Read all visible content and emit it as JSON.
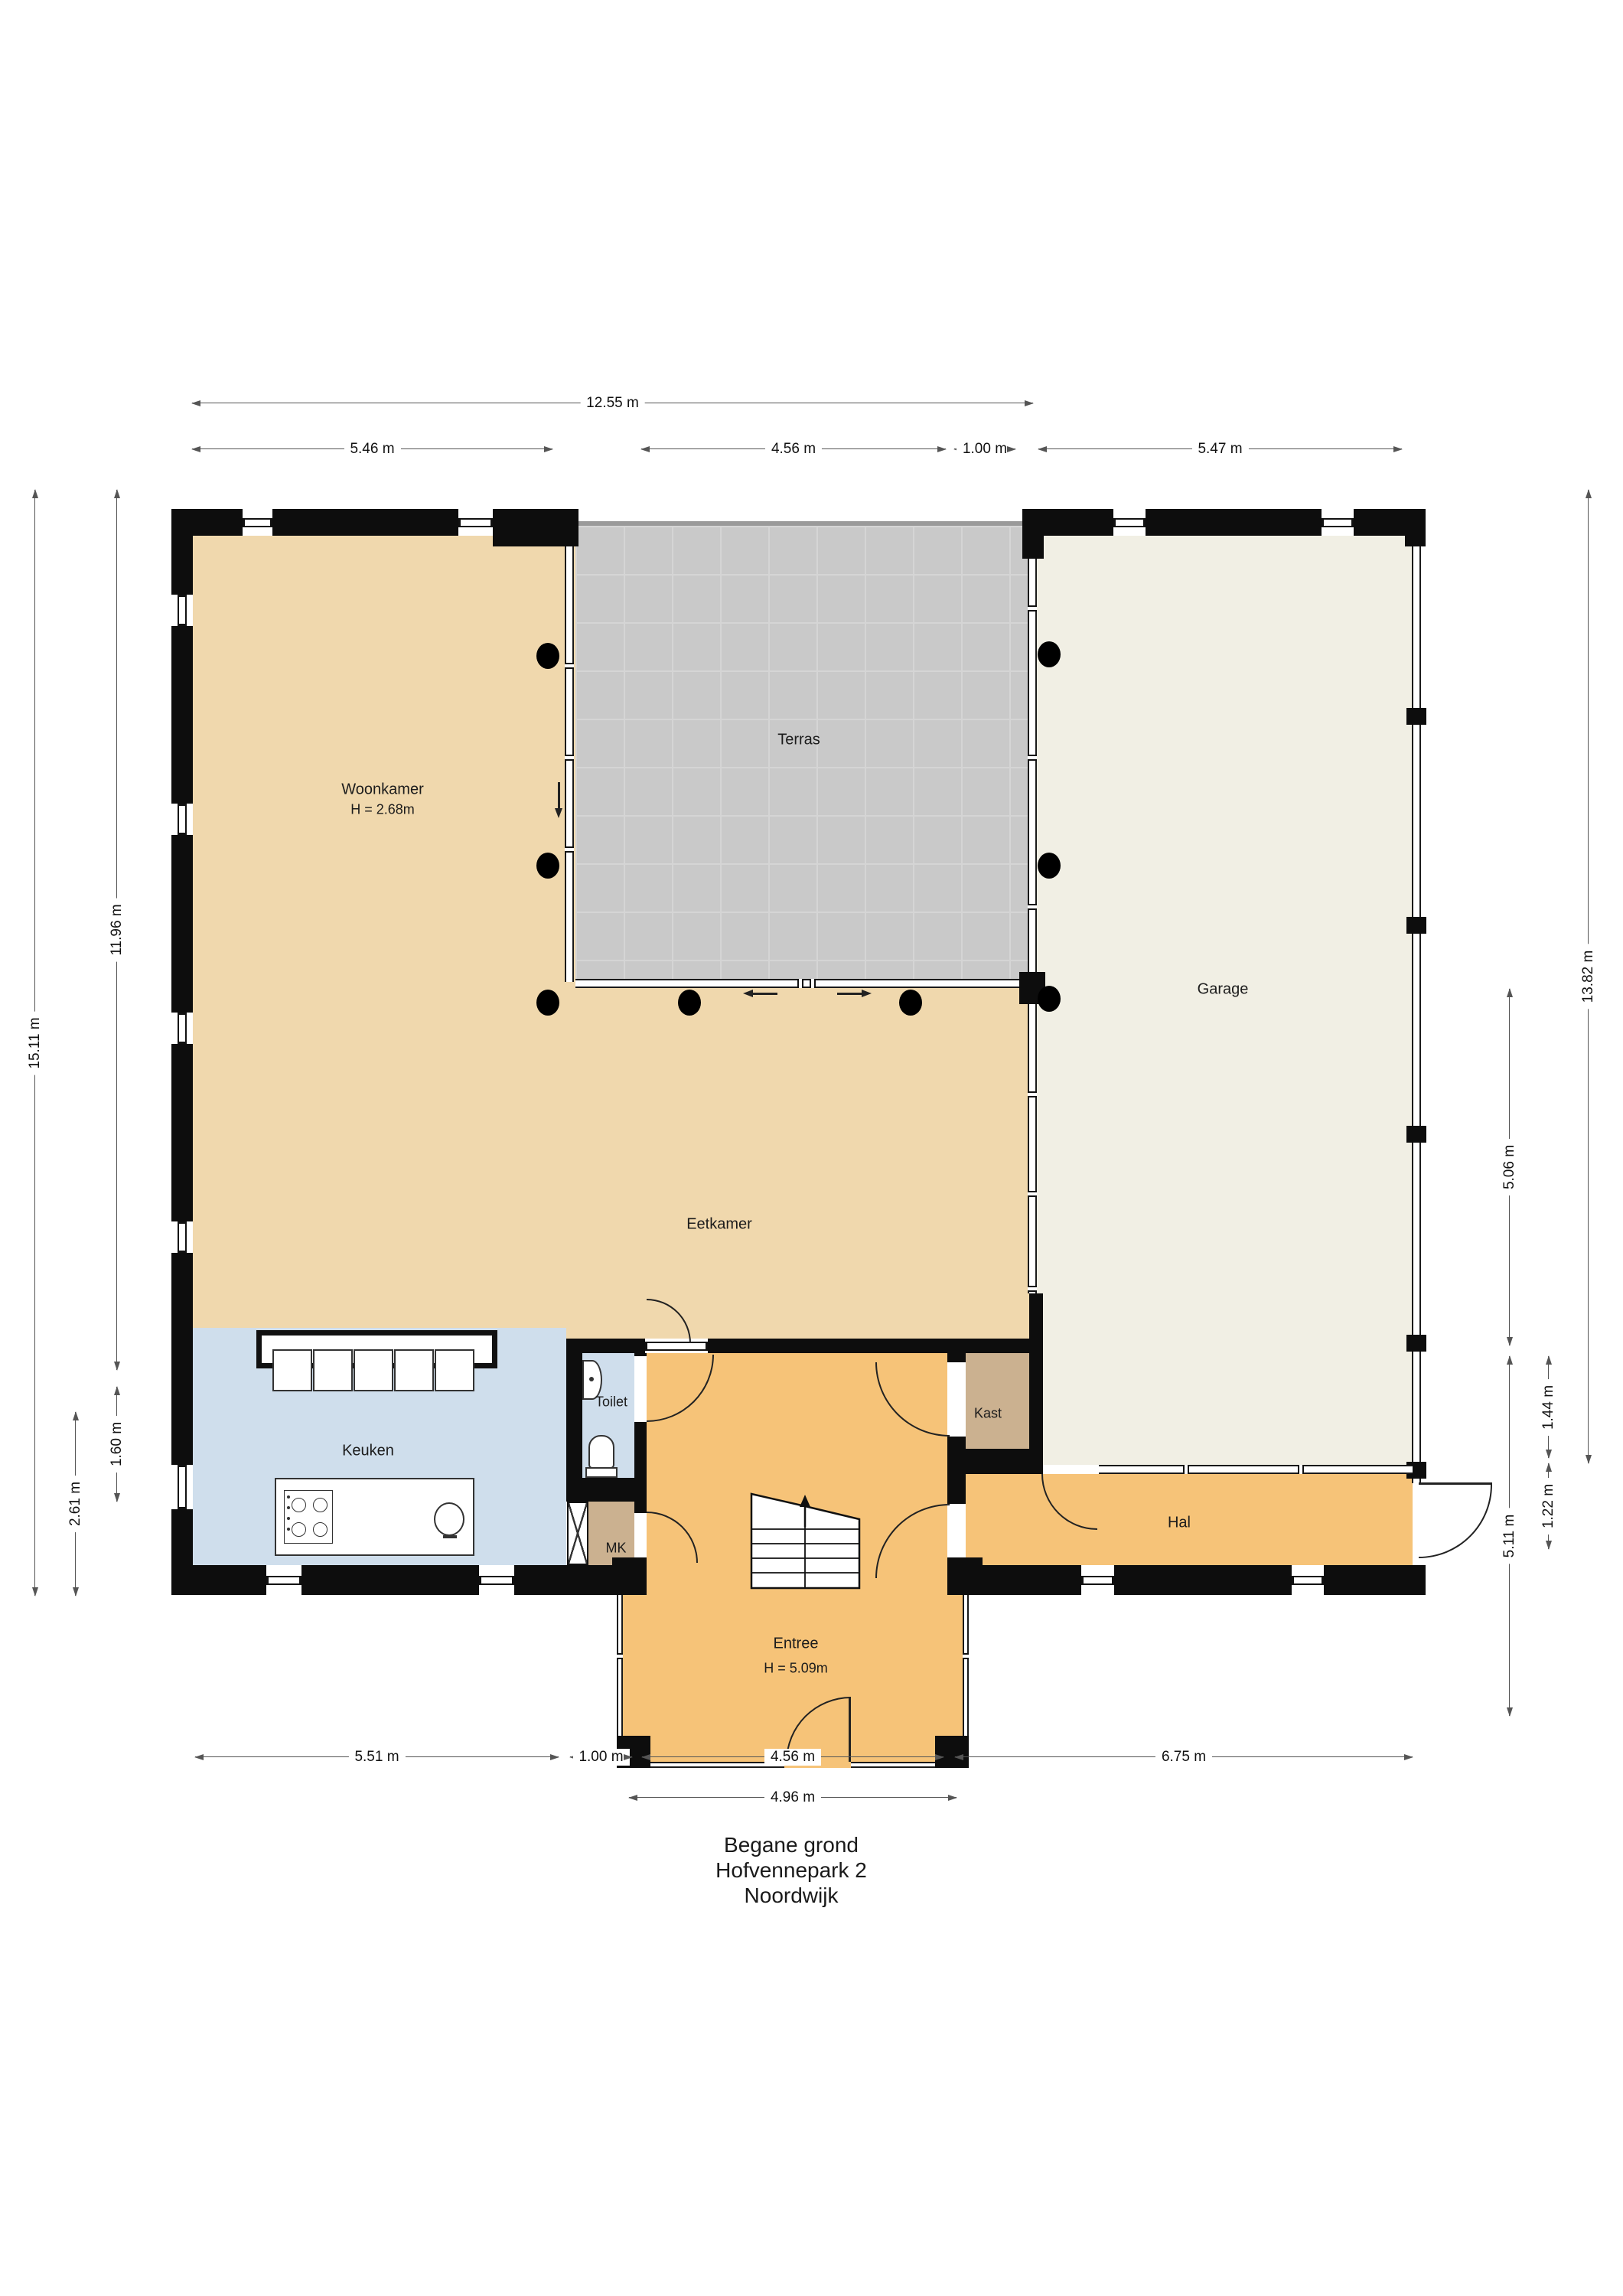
{
  "title": {
    "line1": "Begane grond",
    "line2": "Hofvennepark 2",
    "line3": "Noordwijk"
  },
  "rooms": {
    "woonkamer": {
      "label": "Woonkamer",
      "height": "H = 2.68m"
    },
    "terras": {
      "label": "Terras"
    },
    "garage": {
      "label": "Garage"
    },
    "eetkamer": {
      "label": "Eetkamer"
    },
    "keuken": {
      "label": "Keuken"
    },
    "toilet": {
      "label": "Toilet"
    },
    "mk": {
      "label": "MK"
    },
    "kast": {
      "label": "Kast"
    },
    "hal": {
      "label": "Hal"
    },
    "entree": {
      "label": "Entree",
      "height": "H = 5.09m"
    }
  },
  "dimensions": {
    "top": [
      {
        "label": "12.55 m"
      },
      {
        "label": "5.46 m"
      },
      {
        "label": "4.56 m"
      },
      {
        "label": "1.00 m"
      },
      {
        "label": "5.47 m"
      }
    ],
    "bottom": [
      {
        "label": "5.51 m"
      },
      {
        "label": "1.00 m"
      },
      {
        "label": "4.56 m"
      },
      {
        "label": "6.75 m"
      },
      {
        "label": "4.96 m"
      }
    ],
    "left": [
      {
        "label": "15.11 m"
      },
      {
        "label": "11.96 m"
      },
      {
        "label": "1.60 m"
      },
      {
        "label": "2.61 m"
      }
    ],
    "right": [
      {
        "label": "13.82 m"
      },
      {
        "label": "5.06 m"
      },
      {
        "label": "1.44 m"
      },
      {
        "label": "1.22 m"
      },
      {
        "label": "5.11 m"
      }
    ]
  },
  "colors": {
    "floor_light_orange": "#f0d8ad",
    "floor_dark_orange": "#f6c378",
    "floor_blue": "#cfdeec",
    "floor_gray_terrace": "#c9c9c9",
    "terrace_grid_line": "#d5d5d5",
    "floor_cream_garage": "#f1efe4",
    "floor_tan_closet": "#cbb190",
    "wall_black": "#0d0d0d",
    "dimension_line": "#555555"
  }
}
